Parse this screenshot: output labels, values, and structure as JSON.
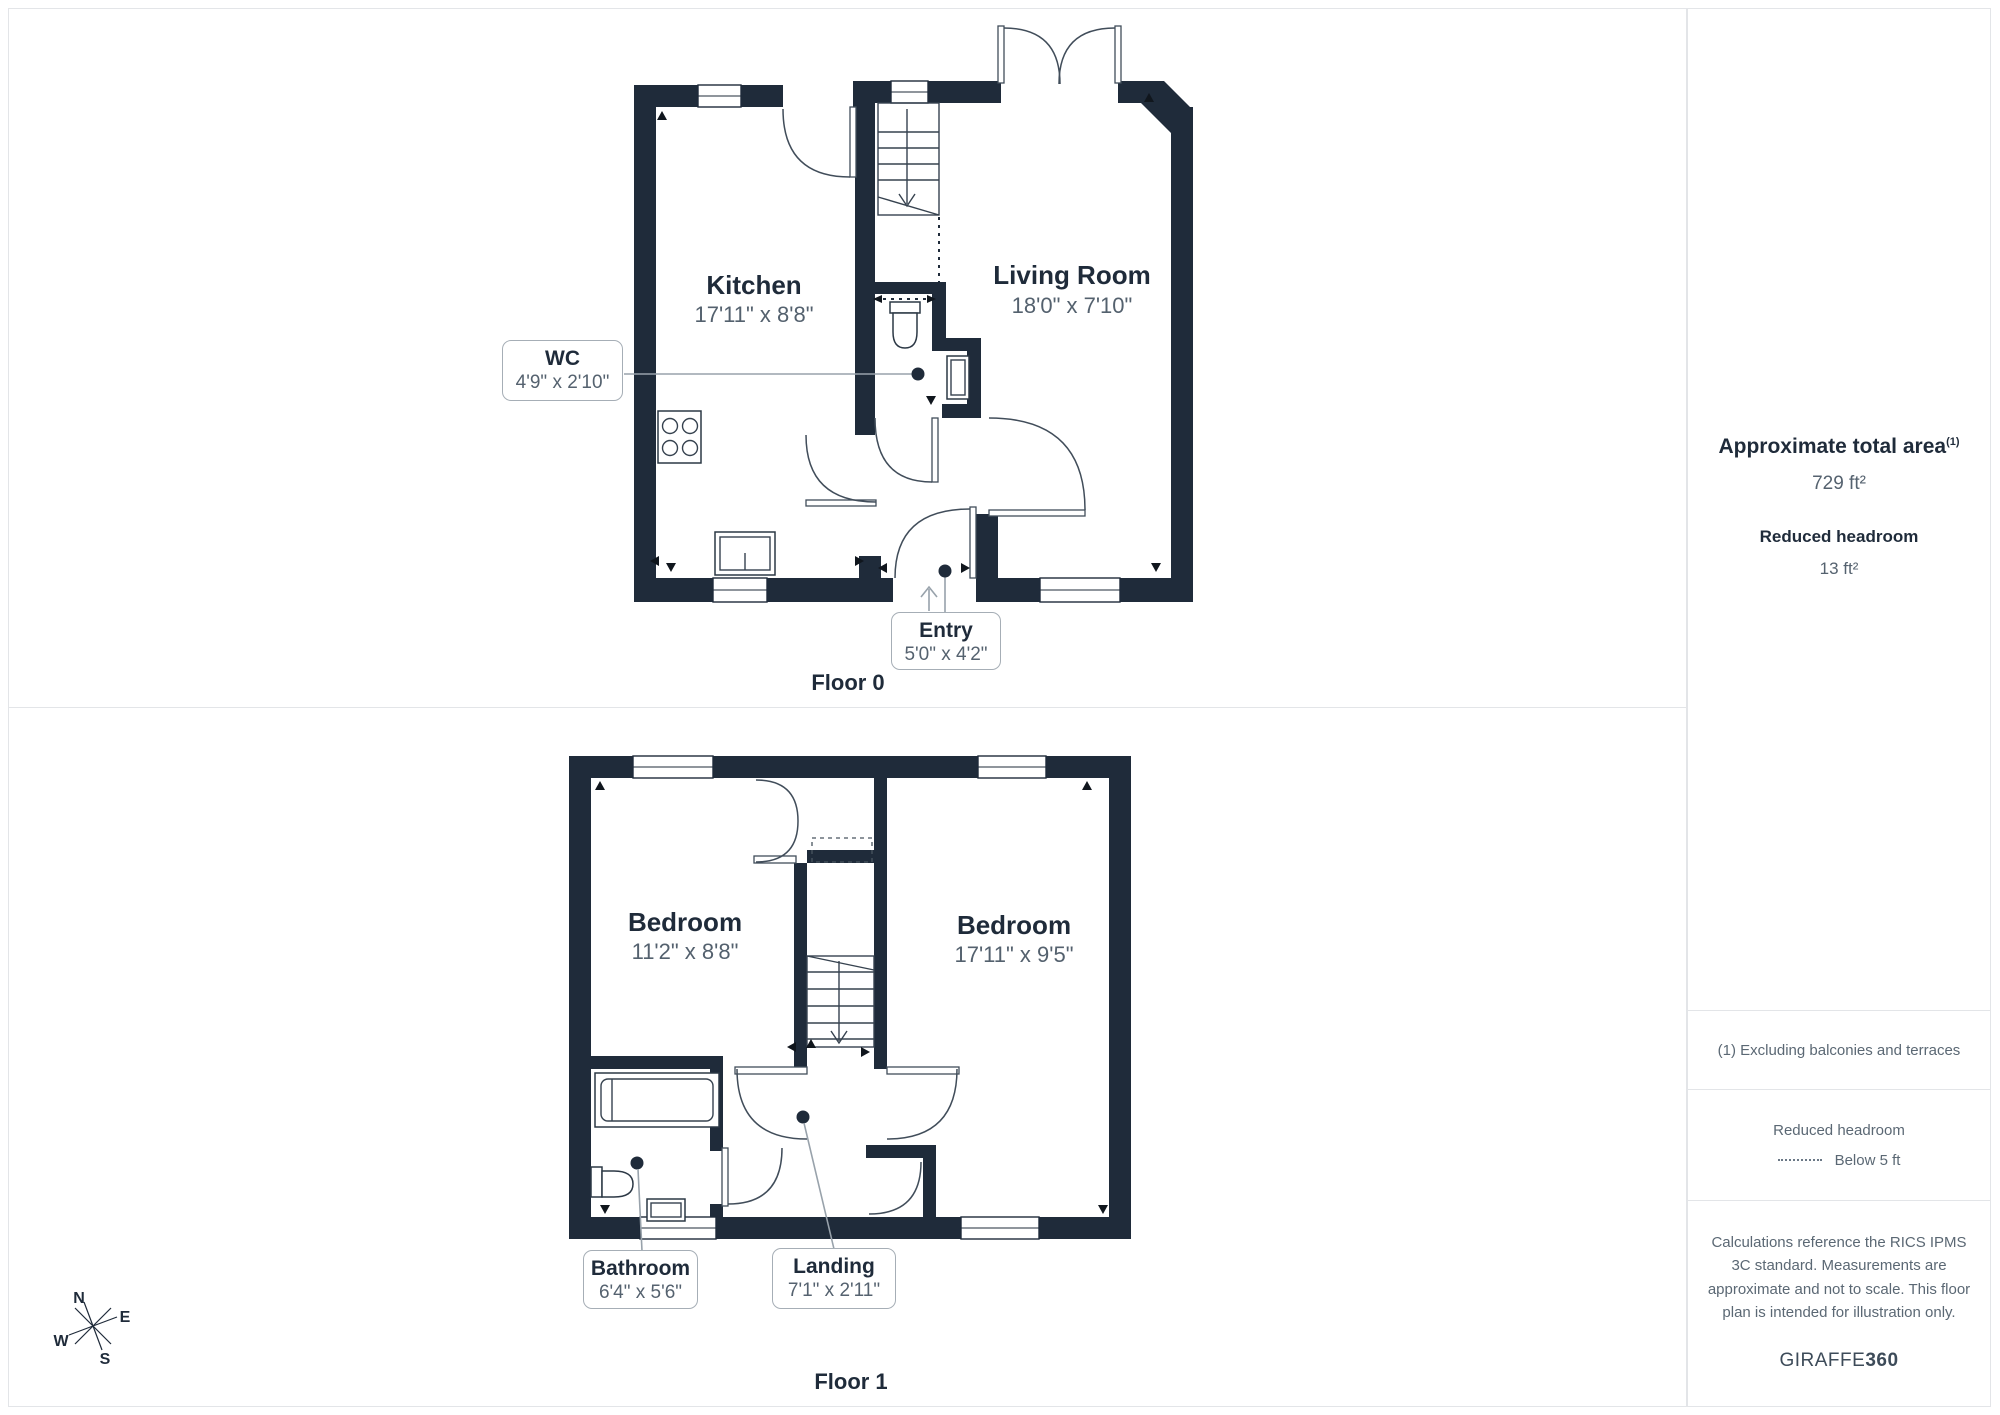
{
  "floor0": {
    "caption": "Floor 0",
    "kitchen_name": "Kitchen",
    "kitchen_dims": "17'11\" x 8'8\"",
    "living_name": "Living Room",
    "living_dims": "18'0\" x 7'10\"",
    "wc_name": "WC",
    "wc_dims": "4'9\" x 2'10\"",
    "entry_name": "Entry",
    "entry_dims": "5'0\" x 4'2\""
  },
  "floor1": {
    "caption": "Floor 1",
    "bedroom1_name": "Bedroom",
    "bedroom1_dims": "11'2\" x 8'8\"",
    "bedroom2_name": "Bedroom",
    "bedroom2_dims": "17'11\" x 9'5\"",
    "bathroom_name": "Bathroom",
    "bathroom_dims": "6'4\" x 5'6\"",
    "landing_name": "Landing",
    "landing_dims": "7'1\" x 2'11\""
  },
  "sidebar": {
    "area_label": "Approximate total area",
    "area_footnote_marker": "(1)",
    "area_value": "729 ft²",
    "headroom_label": "Reduced headroom",
    "headroom_value": "13 ft²",
    "footnote": "(1) Excluding balconies and terraces",
    "legend_title": "Reduced headroom",
    "legend_item": "Below 5 ft",
    "disclaimer": "Calculations reference the RICS IPMS 3C standard. Measurements are approximate and not to scale. This floor plan is intended for illustration only.",
    "brand": "GIRAFFE",
    "brand_suffix": "360"
  },
  "compass": {
    "n": "N",
    "e": "E",
    "s": "S",
    "w": "W"
  },
  "colors": {
    "wall": "#1f2b3a",
    "text_dark": "#1f2b3a",
    "text_gray": "#55626f",
    "border": "#e3e5e8"
  }
}
